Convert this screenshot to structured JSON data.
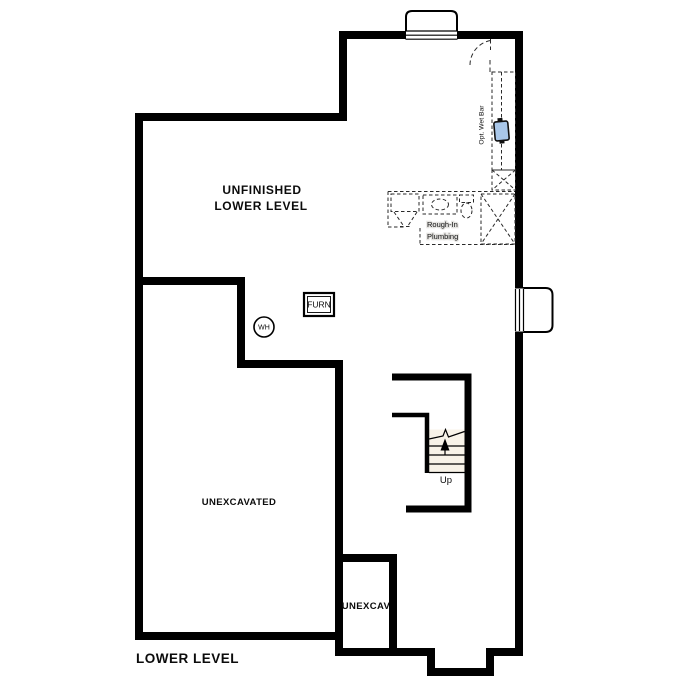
{
  "floor_plan": {
    "plan_title": "LOWER LEVEL",
    "rooms": {
      "main_line1": "UNFINISHED",
      "main_line2": "LOWER LEVEL",
      "unexcavated": "UNEXCAVATED",
      "unexcavated_small": "UNEXCAV"
    },
    "labels": {
      "furnace": "FURN",
      "water_heater": "WH",
      "stairs_direction": "Up",
      "rough_in_line1": "Rough-In",
      "rough_in_line2": "Plumbing",
      "optional_wet_bar": "Opt. Wet Bar"
    },
    "colors": {
      "wall": "#000000",
      "floor": "#e4e3e0",
      "stair_fill": "#f8f3e8",
      "counter": "#d8c5a6",
      "sink": "#a9c7e9",
      "background": "#ffffff"
    }
  }
}
